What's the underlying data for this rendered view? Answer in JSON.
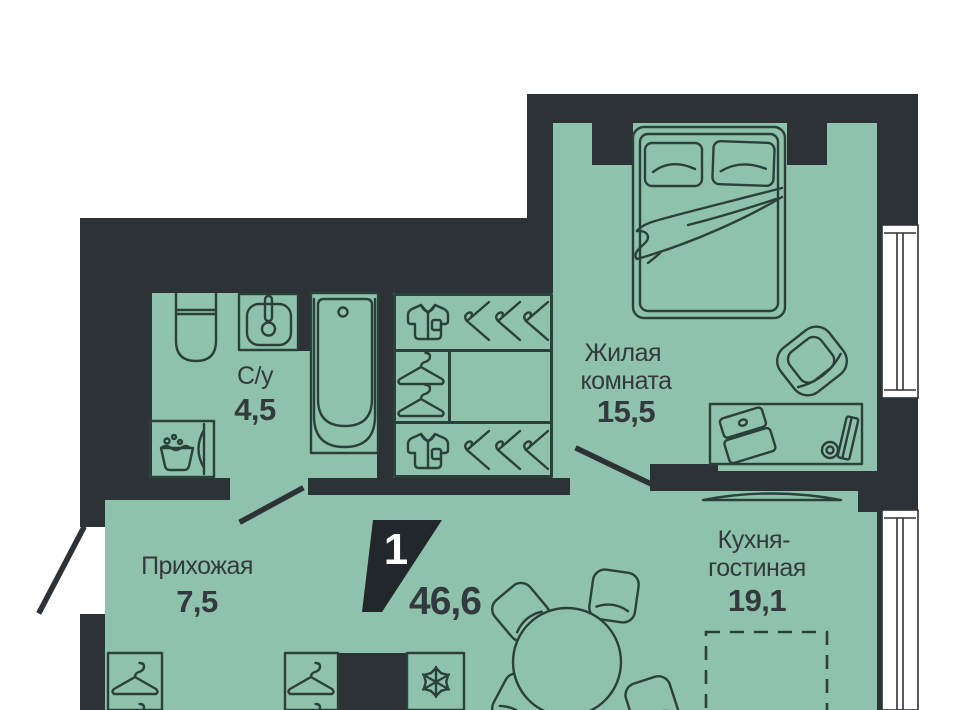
{
  "plan": {
    "badge": {
      "rooms_count": "1",
      "total_area": "46,6"
    },
    "rooms": {
      "living": {
        "name_line1": "Жилая",
        "name_line2": "комната",
        "area": "15,5"
      },
      "bathroom": {
        "name": "С/у",
        "area": "4,5"
      },
      "hallway": {
        "name": "Прихожая",
        "area": "7,5"
      },
      "kitchen": {
        "name_line1": "Кухня-",
        "name_line2": "гостиная",
        "area": "19,1"
      }
    },
    "colors": {
      "floor": "#8fc2ad",
      "wall": "#2d3237",
      "furniture_line": "#2c403b",
      "text": "#333a3d",
      "badge_bg": "#22272b",
      "badge_text": "#ffffff",
      "window": "#ffffff"
    }
  }
}
